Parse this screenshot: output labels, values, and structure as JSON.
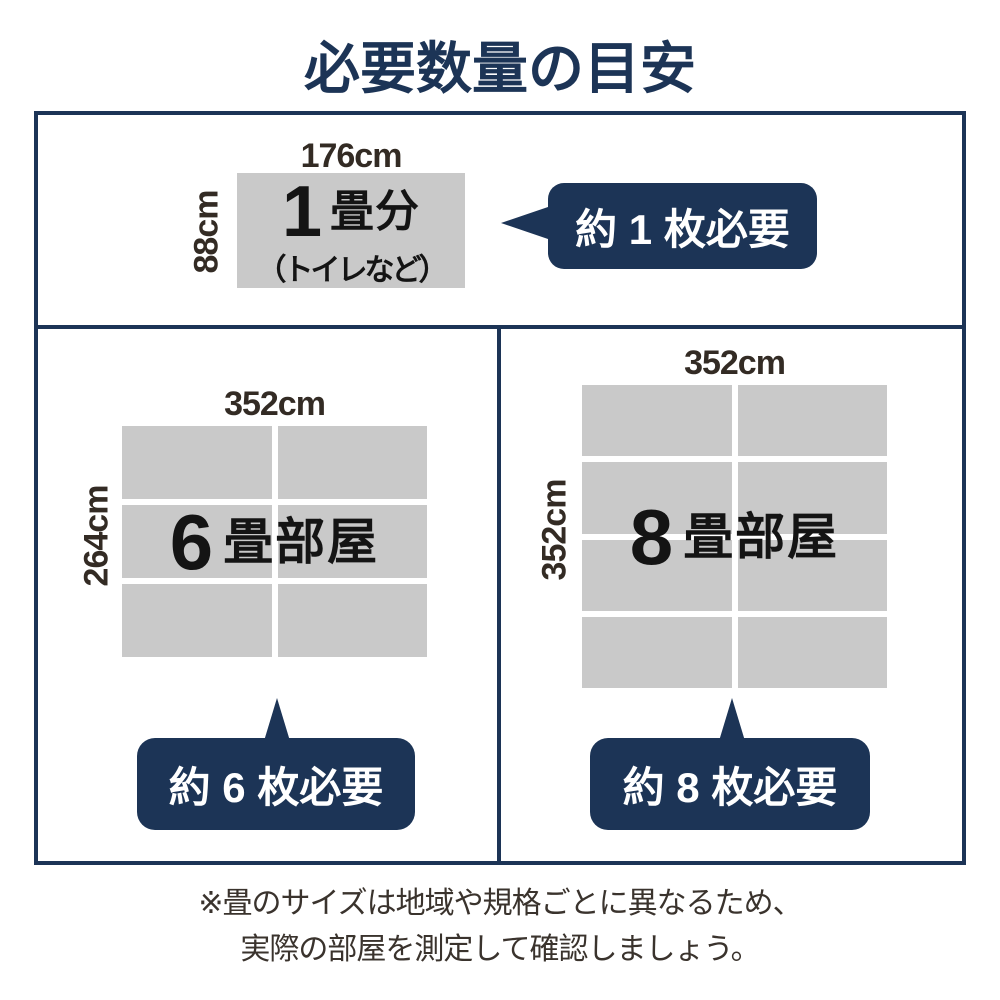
{
  "title": "必要数量の目安",
  "colors": {
    "navy": "#1c3456",
    "cell-gray": "#c9c9c9",
    "ink": "#141414",
    "dim-ink": "#332b24",
    "note-ink": "#3a332d"
  },
  "one_tatami": {
    "width_label": "176cm",
    "height_label": "88cm",
    "big": "1",
    "unit": "畳分",
    "note": "（トイレなど）",
    "badge": "約 1 枚必要"
  },
  "six_tatami": {
    "width_label": "352cm",
    "height_label": "264cm",
    "big": "6",
    "unit": "畳部屋",
    "badge": "約 6 枚必要",
    "grid": {
      "rows": 3,
      "cols": 2
    }
  },
  "eight_tatami": {
    "width_label": "352cm",
    "height_label": "352cm",
    "big": "8",
    "unit": "畳部屋",
    "badge": "約 8 枚必要",
    "grid": {
      "rows": 4,
      "cols": 2
    }
  },
  "note": {
    "line1": "※畳のサイズは地域や規格ごとに異なるため、",
    "line2": "実際の部屋を測定して確認しましょう。"
  }
}
